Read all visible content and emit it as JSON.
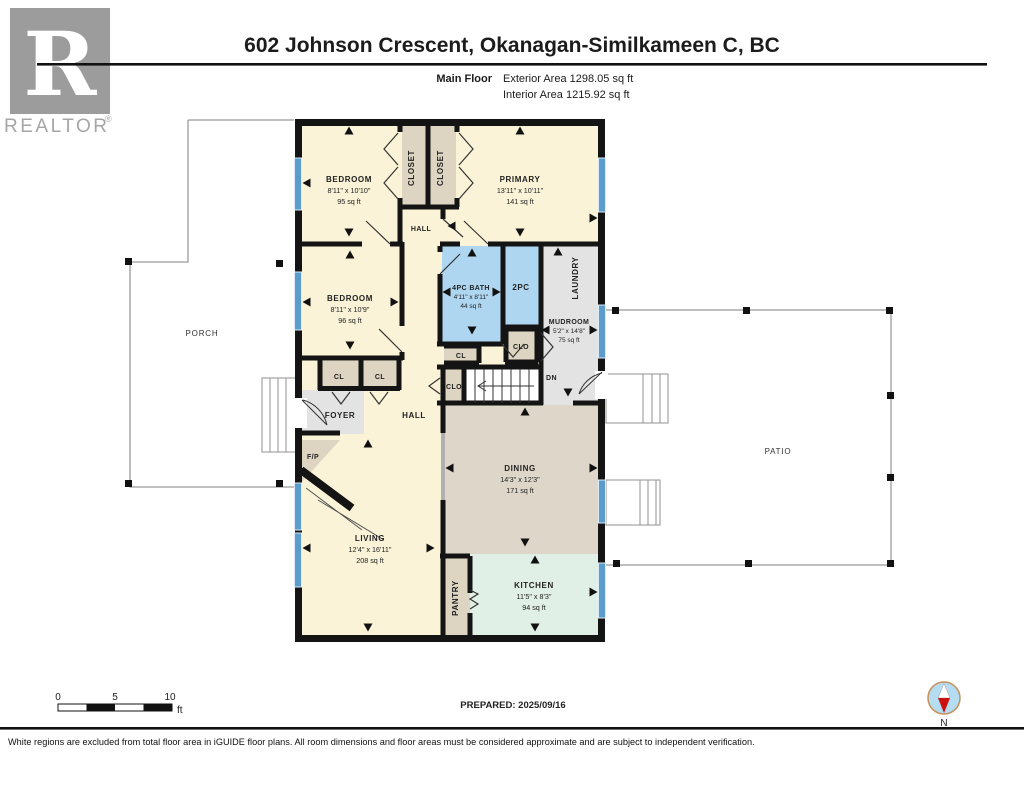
{
  "header": {
    "title": "602 Johnson Crescent, Okanagan-Similkameen C, BC",
    "floor_label": "Main Floor",
    "exterior_area": "Exterior Area 1298.05 sq ft",
    "interior_area": "Interior Area 1215.92 sq ft"
  },
  "logo": {
    "letter": "R",
    "realtor_text": "REALTOR",
    "registered": "®"
  },
  "rooms": {
    "bedroom1": {
      "name": "BEDROOM",
      "dims": "8'11\" x 10'10\"",
      "area": "95 sq ft"
    },
    "closet1": {
      "name": "CLOSET"
    },
    "closet2": {
      "name": "CLOSET"
    },
    "primary": {
      "name": "PRIMARY",
      "dims": "13'11\" x 10'11\"",
      "area": "141 sq ft"
    },
    "hall_upper": {
      "name": "HALL"
    },
    "bedroom2": {
      "name": "BEDROOM",
      "dims": "8'11\" x 10'9\"",
      "area": "96 sq ft"
    },
    "bath": {
      "name": "4PC BATH",
      "dims": "4'11\" x 8'11\"",
      "area": "44 sq ft"
    },
    "wc": {
      "name": "2PC"
    },
    "laundry": {
      "name": "LAUNDRY"
    },
    "mudroom": {
      "name": "MUDROOM",
      "dims": "5'2\" x 14'8\"",
      "area": "75 sq ft"
    },
    "clo_mud": {
      "name": "CLO"
    },
    "cl_bath": {
      "name": "CL"
    },
    "clo_stairs": {
      "name": "CLO"
    },
    "dn": {
      "name": "DN"
    },
    "cl1": {
      "name": "CL"
    },
    "cl2": {
      "name": "CL"
    },
    "foyer": {
      "name": "FOYER"
    },
    "hall_main": {
      "name": "HALL"
    },
    "fp": {
      "name": "F/P"
    },
    "dining": {
      "name": "DINING",
      "dims": "14'3\" x 12'3\"",
      "area": "171 sq ft"
    },
    "living": {
      "name": "LIVING",
      "dims": "12'4\" x 16'11\"",
      "area": "208 sq ft"
    },
    "pantry": {
      "name": "PANTRY"
    },
    "kitchen": {
      "name": "KITCHEN",
      "dims": "11'5\" x 8'3\"",
      "area": "94 sq ft"
    },
    "porch": {
      "name": "PORCH"
    },
    "patio": {
      "name": "PATIO"
    }
  },
  "scale_bar": {
    "tick0": "0",
    "tick5": "5",
    "tick10": "10",
    "unit": "ft"
  },
  "prepared": {
    "label": "PREPARED: 2025/09/16"
  },
  "compass": {
    "label": "N"
  },
  "footer": {
    "disclaimer": "White regions are excluded from total floor area in iGUIDE floor plans. All room dimensions and floor areas must be considered approximate and are subject to independent verification."
  },
  "colors": {
    "room_cream": "#faf3d7",
    "closet_tan": "#ddd4c1",
    "bath_blue": "#aed6f0",
    "gray": "#e3e3e3",
    "dining_tan": "#ded7c9",
    "kitchen_green": "#e1f0e6",
    "window_blue": "#5b9ccd",
    "wall_black": "#141414"
  }
}
